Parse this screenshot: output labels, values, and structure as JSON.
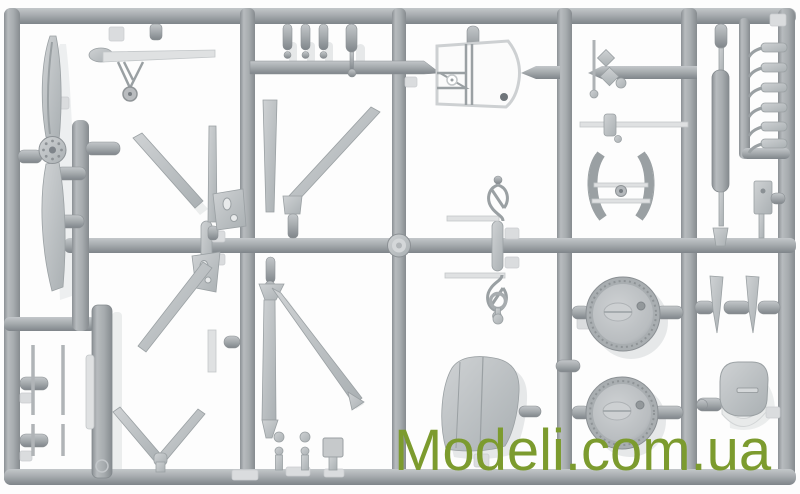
{
  "watermark": {
    "text": "Modeli.com.ua",
    "color": "#7C9B2E"
  },
  "colors": {
    "background": "#fdfdfd",
    "runner": "#a6abae",
    "runner-light": "#c3c7ca",
    "runner-dark": "#83898d",
    "part": "#c2c5c8",
    "part-light": "#dfe1e2",
    "part-dark": "#9aa0a3",
    "pad": "#dadcde",
    "shadow": "#e6e8e9",
    "hole": "#6f757a"
  },
  "photo": {
    "subject": "model-kit-sprue",
    "parts": [
      "propeller",
      "tail-skid-with-wheel",
      "wing-strut-diagonals",
      "strut-brackets",
      "landing-gear-v-strut",
      "thin-rod-parts",
      "side-panel",
      "bullet-gate-stubs",
      "cockpit-frame",
      "control-loops",
      "control-stick-parts",
      "cabane-arcs",
      "exhaust-cylinder",
      "hook-parts",
      "mounting-plate",
      "main-wheel",
      "main-wheel",
      "interplane-strut-blades",
      "engine-cowling",
      "tail-fin",
      "ball-joint-posts"
    ]
  }
}
